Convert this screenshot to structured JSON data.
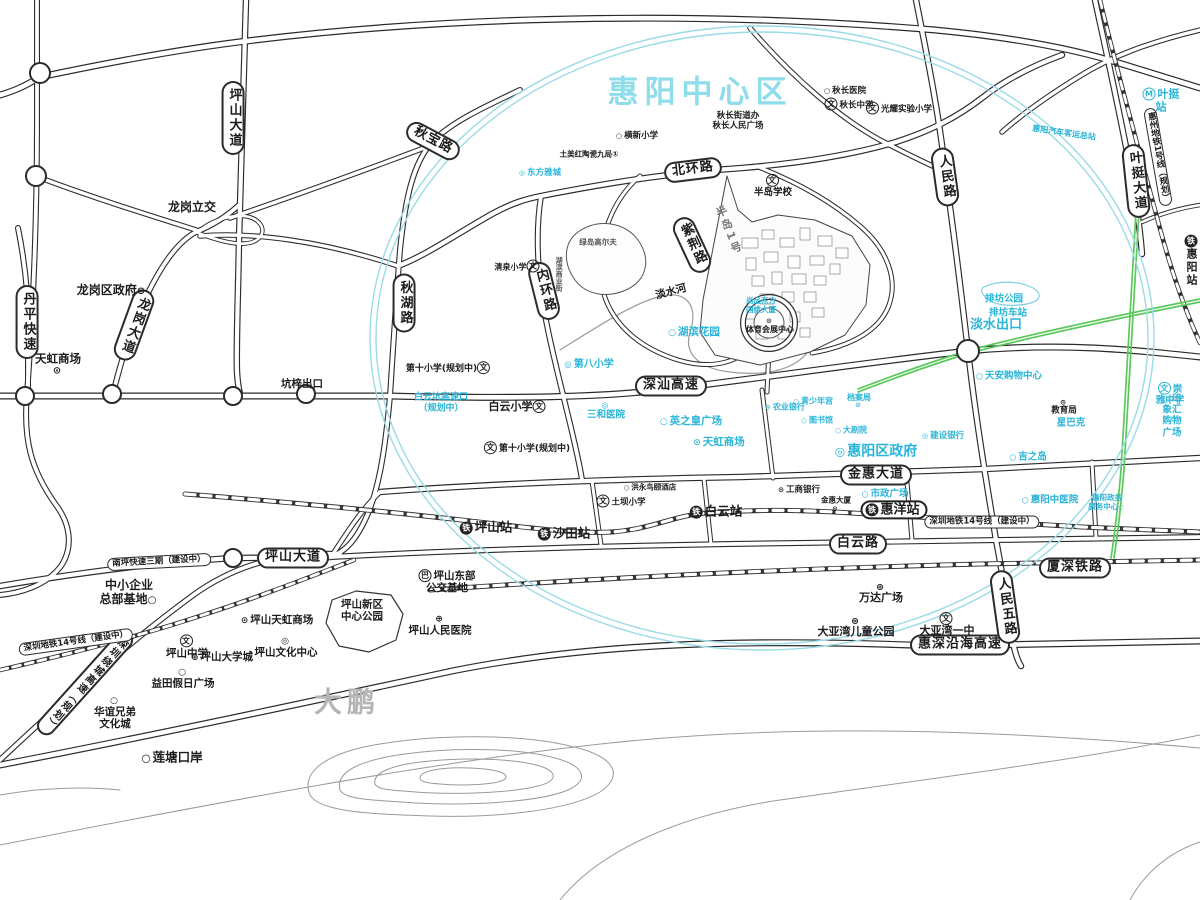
{
  "colors": {
    "poi_cyan": "#2ab5d8",
    "title_cyan": "#8fdcea",
    "green_line": "#5bc85b",
    "ellipse_cyan": "#9adbe6",
    "road_dark": "#2b2b2b"
  },
  "labels": {
    "title": {
      "t": "惠阳中心区",
      "x": 700,
      "y": 93
    },
    "area": [
      {
        "t": "大鹏",
        "x": 347,
        "y": 702,
        "fs": 28,
        "color": "#b5b5b5",
        "ls": 5
      }
    ],
    "roads": [
      {
        "t": "坪山大道",
        "x": 233,
        "y": 118,
        "v": 1
      },
      {
        "t": "秋宝路",
        "x": 433,
        "y": 141,
        "rot": 28
      },
      {
        "t": "秋湖路",
        "x": 404,
        "y": 303,
        "v": 1
      },
      {
        "t": "内环路",
        "x": 544,
        "y": 291,
        "v": 1,
        "rot": -14
      },
      {
        "t": "北环路",
        "x": 693,
        "y": 170,
        "rot": -7
      },
      {
        "t": "紫荆路",
        "x": 692,
        "y": 245,
        "v": 1,
        "rot": -25
      },
      {
        "t": "人民路",
        "x": 945,
        "y": 177,
        "v": 1,
        "rot": -8
      },
      {
        "t": "叶挺大道",
        "x": 1136,
        "y": 181,
        "v": 1,
        "rot": -6
      },
      {
        "t": "丹平快速",
        "x": 27,
        "y": 322,
        "v": 1
      },
      {
        "t": "龙岗大道",
        "x": 134,
        "y": 325,
        "v": 1,
        "rot": 20
      },
      {
        "t": "深汕高速",
        "x": 671,
        "y": 386
      },
      {
        "t": "金惠大道",
        "x": 876,
        "y": 475
      },
      {
        "t": "白云路",
        "x": 858,
        "y": 544
      },
      {
        "t": "坪山大道",
        "x": 293,
        "y": 558
      },
      {
        "t": "南坪快速三期（建设中）",
        "x": 159,
        "y": 562,
        "sm": 1,
        "rot": -3
      },
      {
        "t": "惠深沿海高速",
        "x": 960,
        "y": 645
      },
      {
        "t": "厦深铁路",
        "x": 1075,
        "y": 568
      },
      {
        "t": "人民五路",
        "x": 1005,
        "y": 607,
        "v": 1,
        "rot": -8
      },
      {
        "t": "深圳绕城高速（规划）",
        "x": 85,
        "y": 683,
        "v": 1,
        "rot": 42,
        "fs": 10
      },
      {
        "t": "深圳地铁14号线（建设中）",
        "x": 76,
        "y": 642,
        "sm": 1,
        "rot": -8
      },
      {
        "t": "深圳地铁14号线（建设中）",
        "x": 982,
        "y": 522,
        "sm": 1
      },
      {
        "t": "惠州地铁1号线（规划）",
        "x": 1158,
        "y": 157,
        "v": 1,
        "rot": -10,
        "sm": 1
      }
    ],
    "stations": [
      {
        "t": "惠洋站",
        "x": 894,
        "y": 510,
        "pill": 1,
        "icon": "铁",
        "fs": 13
      },
      {
        "t": "坪山站",
        "x": 486,
        "y": 528,
        "icon": "铁",
        "fs": 12.5
      },
      {
        "t": "沙田站",
        "x": 564,
        "y": 534,
        "icon": "铁",
        "fs": 12.5
      },
      {
        "t": "白云站",
        "x": 716,
        "y": 512,
        "icon": "铁",
        "fs": 12.5
      },
      {
        "t": "惠阳站",
        "x": 1192,
        "y": 261,
        "icon": "铁",
        "fs": 11
      },
      {
        "t": "叶挺站",
        "x": 1161,
        "y": 101,
        "icon": "M",
        "fs": 11,
        "color": "#2ab5d8"
      }
    ],
    "poi_black": [
      {
        "t": "龙岗立交",
        "x": 192,
        "y": 207,
        "fs": 12
      },
      {
        "t": "龙岗区政府",
        "x": 112,
        "y": 290,
        "fs": 12,
        "icon": "⊛",
        "ip": "after"
      },
      {
        "t": "天虹商场",
        "x": 58,
        "y": 364,
        "fs": 11.5,
        "icon": "⊙",
        "ip": "below"
      },
      {
        "t": "坑梓出口",
        "x": 302,
        "y": 384,
        "fs": 10.5
      },
      {
        "t": "秋长医院",
        "x": 845,
        "y": 91,
        "fs": 8.5,
        "icon": "○"
      },
      {
        "t": "秋长中学",
        "x": 849,
        "y": 104,
        "fs": 8.5,
        "icon": "文"
      },
      {
        "t": "光耀实验小学",
        "x": 899,
        "y": 108,
        "fs": 8.5,
        "icon": "文"
      },
      {
        "t": "秋长街道办\n秋长人民广场",
        "x": 738,
        "y": 121,
        "fs": 8.5
      },
      {
        "t": "横新小学",
        "x": 637,
        "y": 136,
        "fs": 8.5,
        "icon": "○"
      },
      {
        "t": "土美红陶瓷九局①",
        "x": 589,
        "y": 155,
        "fs": 7.5
      },
      {
        "t": "半岛学校",
        "x": 773,
        "y": 186,
        "fs": 9.5,
        "icon": "文",
        "ip": "above"
      },
      {
        "t": "半岛1号",
        "x": 728,
        "y": 231,
        "v": 1,
        "rot": -22,
        "fs": 11,
        "color": "#777777",
        "ls": 3
      },
      {
        "t": "淡水河",
        "x": 671,
        "y": 292,
        "fs": 10.5,
        "rot": -15
      },
      {
        "t": "体育会展中心",
        "x": 770,
        "y": 326,
        "fs": 8,
        "icon": "⊙",
        "ip": "above"
      },
      {
        "t": "清泉小学",
        "x": 518,
        "y": 266,
        "fs": 8,
        "icon": "文",
        "ip": "after"
      },
      {
        "t": "绿岛高尔夫",
        "x": 598,
        "y": 243,
        "fs": 7.5,
        "color": "#555555"
      },
      {
        "t": "湖滨商业街",
        "x": 559,
        "y": 274,
        "v": 1,
        "fs": 7,
        "color": "#555555"
      },
      {
        "t": "第十小学(规划中)",
        "x": 449,
        "y": 368,
        "fs": 9,
        "icon": "文",
        "ip": "after"
      },
      {
        "t": "白云小学",
        "x": 518,
        "y": 407,
        "fs": 11,
        "icon": "文",
        "ip": "after"
      },
      {
        "t": "第十小学(规划中)",
        "x": 527,
        "y": 448,
        "fs": 9,
        "icon": "文"
      },
      {
        "t": "土坝小学",
        "x": 621,
        "y": 501,
        "fs": 8.5,
        "icon": "文"
      },
      {
        "t": "洪永鸟颐酒店",
        "x": 650,
        "y": 488,
        "fs": 7.5,
        "icon": "○"
      },
      {
        "t": "工商银行",
        "x": 799,
        "y": 490,
        "fs": 8.5,
        "icon": "⊙"
      },
      {
        "t": "金惠大厦",
        "x": 836,
        "y": 504,
        "fs": 7.5,
        "icon": "⊙",
        "ip": "below"
      },
      {
        "t": "教育局",
        "x": 1064,
        "y": 407,
        "fs": 8.5,
        "icon": "⊙",
        "ip": "above"
      },
      {
        "t": "万达广场",
        "x": 881,
        "y": 594,
        "fs": 11,
        "icon": "⊕",
        "ip": "above"
      },
      {
        "t": "大亚湾儿童公园",
        "x": 856,
        "y": 628,
        "fs": 11,
        "icon": "⊛",
        "ip": "above"
      },
      {
        "t": "大亚湾一中",
        "x": 947,
        "y": 625,
        "fs": 11,
        "icon": "文",
        "ip": "above"
      },
      {
        "t": "中小企业\n总部基地",
        "x": 129,
        "y": 592,
        "fs": 12,
        "icon": "○",
        "ip": "after"
      },
      {
        "t": "坪山东部\n公交基地",
        "x": 447,
        "y": 582,
        "fs": 10.5,
        "icon": "巴"
      },
      {
        "t": "坪山新区\n中心公园",
        "x": 362,
        "y": 611,
        "fs": 10.5
      },
      {
        "t": "坪山人民医院",
        "x": 440,
        "y": 626,
        "fs": 10.5,
        "icon": "⊕",
        "ip": "above"
      },
      {
        "t": "坪山天虹商场",
        "x": 277,
        "y": 620,
        "fs": 10.5,
        "icon": "⊙"
      },
      {
        "t": "坪山文化中心",
        "x": 286,
        "y": 648,
        "fs": 10.5,
        "icon": "◎",
        "ip": "above"
      },
      {
        "t": "坪山中学",
        "x": 187,
        "y": 647,
        "fs": 10.5,
        "icon": "文",
        "ip": "above"
      },
      {
        "t": "坪山大学城",
        "x": 222,
        "y": 657,
        "fs": 10.5,
        "icon": "⊕"
      },
      {
        "t": "益田假日广场",
        "x": 183,
        "y": 679,
        "fs": 10.5,
        "icon": "○",
        "ip": "above"
      },
      {
        "t": "华谊兄弟\n文化城",
        "x": 115,
        "y": 714,
        "fs": 10.5,
        "icon": "○",
        "ip": "above"
      },
      {
        "t": "莲塘口岸",
        "x": 172,
        "y": 758,
        "fs": 12.5,
        "icon": "○"
      }
    ],
    "poi_cyan": [
      {
        "t": "东方雅城",
        "x": 540,
        "y": 173,
        "fs": 8.5,
        "icon": "◎"
      },
      {
        "t": "惠阳汽车客运总站",
        "x": 1064,
        "y": 133,
        "fs": 8,
        "rot": 8
      },
      {
        "t": "湖滨花园",
        "x": 694,
        "y": 332,
        "fs": 10.5,
        "icon": "○"
      },
      {
        "t": "尚品东方\n国维大厦",
        "x": 761,
        "y": 306,
        "fs": 7.5
      },
      {
        "t": "排坊公园",
        "x": 1004,
        "y": 299,
        "fs": 9.5
      },
      {
        "t": "排坊车站",
        "x": 1008,
        "y": 313,
        "fs": 9.5
      },
      {
        "t": "淡水出口",
        "x": 996,
        "y": 325,
        "fs": 13
      },
      {
        "t": "第八小学",
        "x": 589,
        "y": 365,
        "fs": 10,
        "icon": "◎"
      },
      {
        "t": "白云坑高速口\n（规划中）",
        "x": 441,
        "y": 403,
        "fs": 9
      },
      {
        "t": "三和医院",
        "x": 606,
        "y": 411,
        "fs": 9.5,
        "icon": "◎",
        "ip": "above"
      },
      {
        "t": "英之皇广场",
        "x": 691,
        "y": 421,
        "fs": 10.5,
        "icon": "○"
      },
      {
        "t": "天虹商场",
        "x": 719,
        "y": 442,
        "fs": 10.5,
        "icon": "⊙"
      },
      {
        "t": "惠阳区政府",
        "x": 876,
        "y": 452,
        "fs": 14,
        "icon": "◎"
      },
      {
        "t": "青少年宫",
        "x": 813,
        "y": 401,
        "fs": 8,
        "icon": "○"
      },
      {
        "t": "农业银行",
        "x": 785,
        "y": 407,
        "fs": 8,
        "icon": "⊙"
      },
      {
        "t": "图书馆",
        "x": 817,
        "y": 420,
        "fs": 8,
        "icon": "○"
      },
      {
        "t": "大剧院",
        "x": 851,
        "y": 430,
        "fs": 8,
        "icon": "○"
      },
      {
        "t": "档案局",
        "x": 859,
        "y": 401,
        "fs": 8,
        "icon": "⊙",
        "ip": "below"
      },
      {
        "t": "建设银行",
        "x": 943,
        "y": 436,
        "fs": 8.5,
        "icon": "◎"
      },
      {
        "t": "天安购物中心",
        "x": 1009,
        "y": 376,
        "fs": 9.5,
        "icon": "○"
      },
      {
        "t": "星巴克",
        "x": 1071,
        "y": 423,
        "fs": 9.5
      },
      {
        "t": "吉之岛",
        "x": 1028,
        "y": 457,
        "fs": 9.5,
        "icon": "○"
      },
      {
        "t": "崇雅中学",
        "x": 1170,
        "y": 394,
        "fs": 9.5,
        "icon": "文"
      },
      {
        "t": "印象汇购物广场",
        "x": 1172,
        "y": 416,
        "fs": 9.5,
        "icon": "○"
      },
      {
        "t": "市政广场",
        "x": 885,
        "y": 494,
        "fs": 9.5,
        "icon": "○"
      },
      {
        "t": "惠阳中医院",
        "x": 1050,
        "y": 500,
        "fs": 9.5,
        "icon": "○"
      },
      {
        "t": "惠阳政务\n服务中心",
        "x": 1107,
        "y": 503,
        "fs": 7.5,
        "icon": "○",
        "ip": "after"
      }
    ]
  }
}
